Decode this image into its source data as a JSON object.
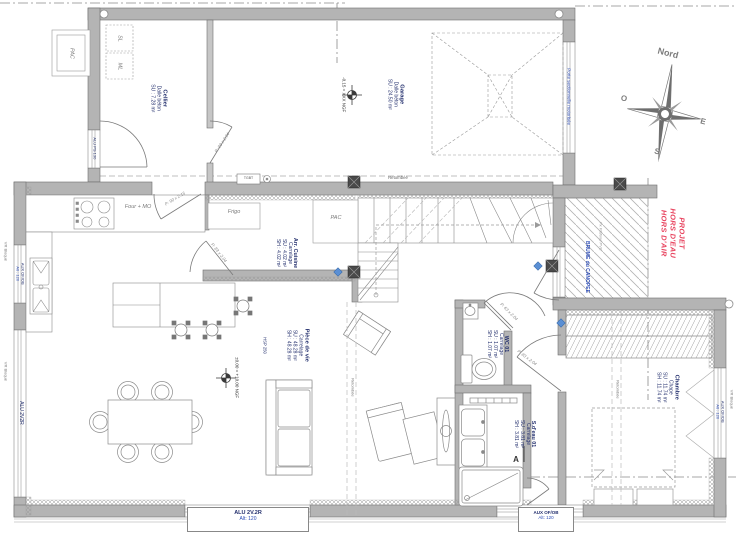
{
  "plan": {
    "rooms": {
      "cellier": {
        "name": "Cellier",
        "floor": "Dalle béton",
        "su": "SU : 7.28 m²"
      },
      "garage": {
        "name": "Garage",
        "floor": "Dalle béton",
        "su": "SU : 24.50 m²"
      },
      "arr_cuisine": {
        "name": "Arr. Cuisine",
        "floor": "Carrelage",
        "su": "SU : 4.02 m²",
        "sh": "SH : 4.02 m²"
      },
      "piece_de_vie": {
        "name": "Pièce de vie",
        "floor": "Carrelage",
        "su": "SU : 48.28 m²",
        "sh": "SH : 48.28 m²",
        "ceiling": "HSP 250"
      },
      "wc": {
        "name": "WC 01",
        "floor": "Carrelage",
        "su": "SU : 1.07 m²",
        "sh": "SH : 1.07 m²"
      },
      "sdeau": {
        "name": "S.d'eau 01",
        "floor": "Carrelage",
        "su": "SU : 3.81 m²",
        "sh": "SH : 3.81 m²"
      },
      "chambre": {
        "name": "Chambre",
        "floor": "Chape",
        "su": "SU : 11.74 m²",
        "sh": "SH : 11.74 m²"
      }
    },
    "levels": {
      "garage": "-0.15 = XXX NGF",
      "living": "±0.00 = +10.00 NGF"
    },
    "equipment": {
      "pac_ext": "PAC",
      "pac_int": "PAC",
      "sl": "SL",
      "ml": "ML",
      "frigo": "Frigo",
      "four": "Four + MO",
      "tgbt": "TGBT"
    },
    "doors": {
      "cellier_entry": "ALU PS 130",
      "cellier_garage": "P: 93 x 2.04",
      "cellier_kitchen": "P: 90 x 2.15",
      "kitchen_arr": "P: 83 x 2.04",
      "wc": "P: 63 x 2.04",
      "chambre": "P: 83 x 2.04",
      "garage_door": "Porte sectionnelle motorisée"
    },
    "windows": {
      "left_kitchen": {
        "type": "AUX OF/OB",
        "alt": "Alt : 120"
      },
      "left_living": {
        "type": "ALU 2V2R"
      },
      "bottom_living": {
        "type": "ALU 2V.2R",
        "alt": "Alt: 120"
      },
      "bottom_bath": {
        "type": "AUX OF/OB",
        "alt": "Alt: 120"
      },
      "right_chambre": {
        "type": "AUX OF/OB",
        "alt": "Alt : 120"
      },
      "shutter_note": "VR Bloqué"
    },
    "annotations": {
      "retombee": "Retombée",
      "brume": "BRUME du CANOPEE",
      "px_plafond": "Px Plafond PVC",
      "section": "A",
      "project_status": [
        "PROJET",
        "HORS D'EAU",
        "HORS D'AIR"
      ]
    },
    "compass": {
      "n": "Nord",
      "e": "E",
      "s": "S",
      "o": "O"
    }
  },
  "colors": {
    "wall": "#b4b4b4",
    "accent_blue": "#2b4bb5",
    "accent_red": "#e8445f",
    "label_navy": "#24306e"
  }
}
